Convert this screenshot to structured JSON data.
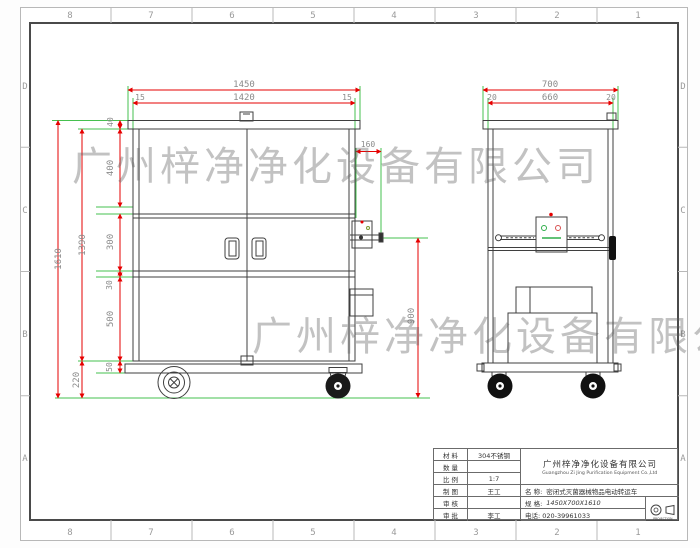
{
  "drawing": {
    "watermark1": "广州梓净净化设备有限公司",
    "watermark2": "广州梓净净化设备有限公司",
    "zones": {
      "cols": [
        "8",
        "7",
        "6",
        "5",
        "4",
        "3",
        "2",
        "1"
      ],
      "rows": [
        "D",
        "C",
        "B",
        "A"
      ]
    },
    "front_view": {
      "dim_overall_width": "1450",
      "dim_inner_width": "1420",
      "dim_margin_left": "15",
      "dim_margin_right": "15",
      "dim_overall_height": "1610",
      "dim_body_height": "1390",
      "dim_lid": "40",
      "dim_top_section": "400",
      "dim_mid_section": "300",
      "dim_rail": "30",
      "dim_bottom_section": "500",
      "dim_base": "50",
      "dim_wheel_height": "220",
      "dim_handle_offset": "160"
    },
    "side_view": {
      "dim_overall_depth": "700",
      "dim_inner_depth": "660",
      "dim_margin_left": "20",
      "dim_margin_right": "20",
      "dim_handle_height": "900"
    }
  },
  "title_block": {
    "rows": [
      {
        "label": "材 料",
        "value": "304不锈钢"
      },
      {
        "label": "数 量",
        "value": ""
      },
      {
        "label": "比 例",
        "value": "1:7"
      },
      {
        "label": "制 图",
        "value": "王工"
      },
      {
        "label": "审 核",
        "value": ""
      },
      {
        "label": "审 批",
        "value": "李工"
      }
    ],
    "company_cn": "广州梓净净化设备有限公司",
    "company_en": "Guangzhou Zi Jing Purification Equipment Co.,Ltd",
    "name_label": "名 称:",
    "name_value": "密闭式灭菌器械物品电动转运车",
    "spec_label": "规 格:",
    "spec_value": "1450X700X1610",
    "phone": "电话: 020-39961033",
    "projection": "PROJECTION"
  }
}
